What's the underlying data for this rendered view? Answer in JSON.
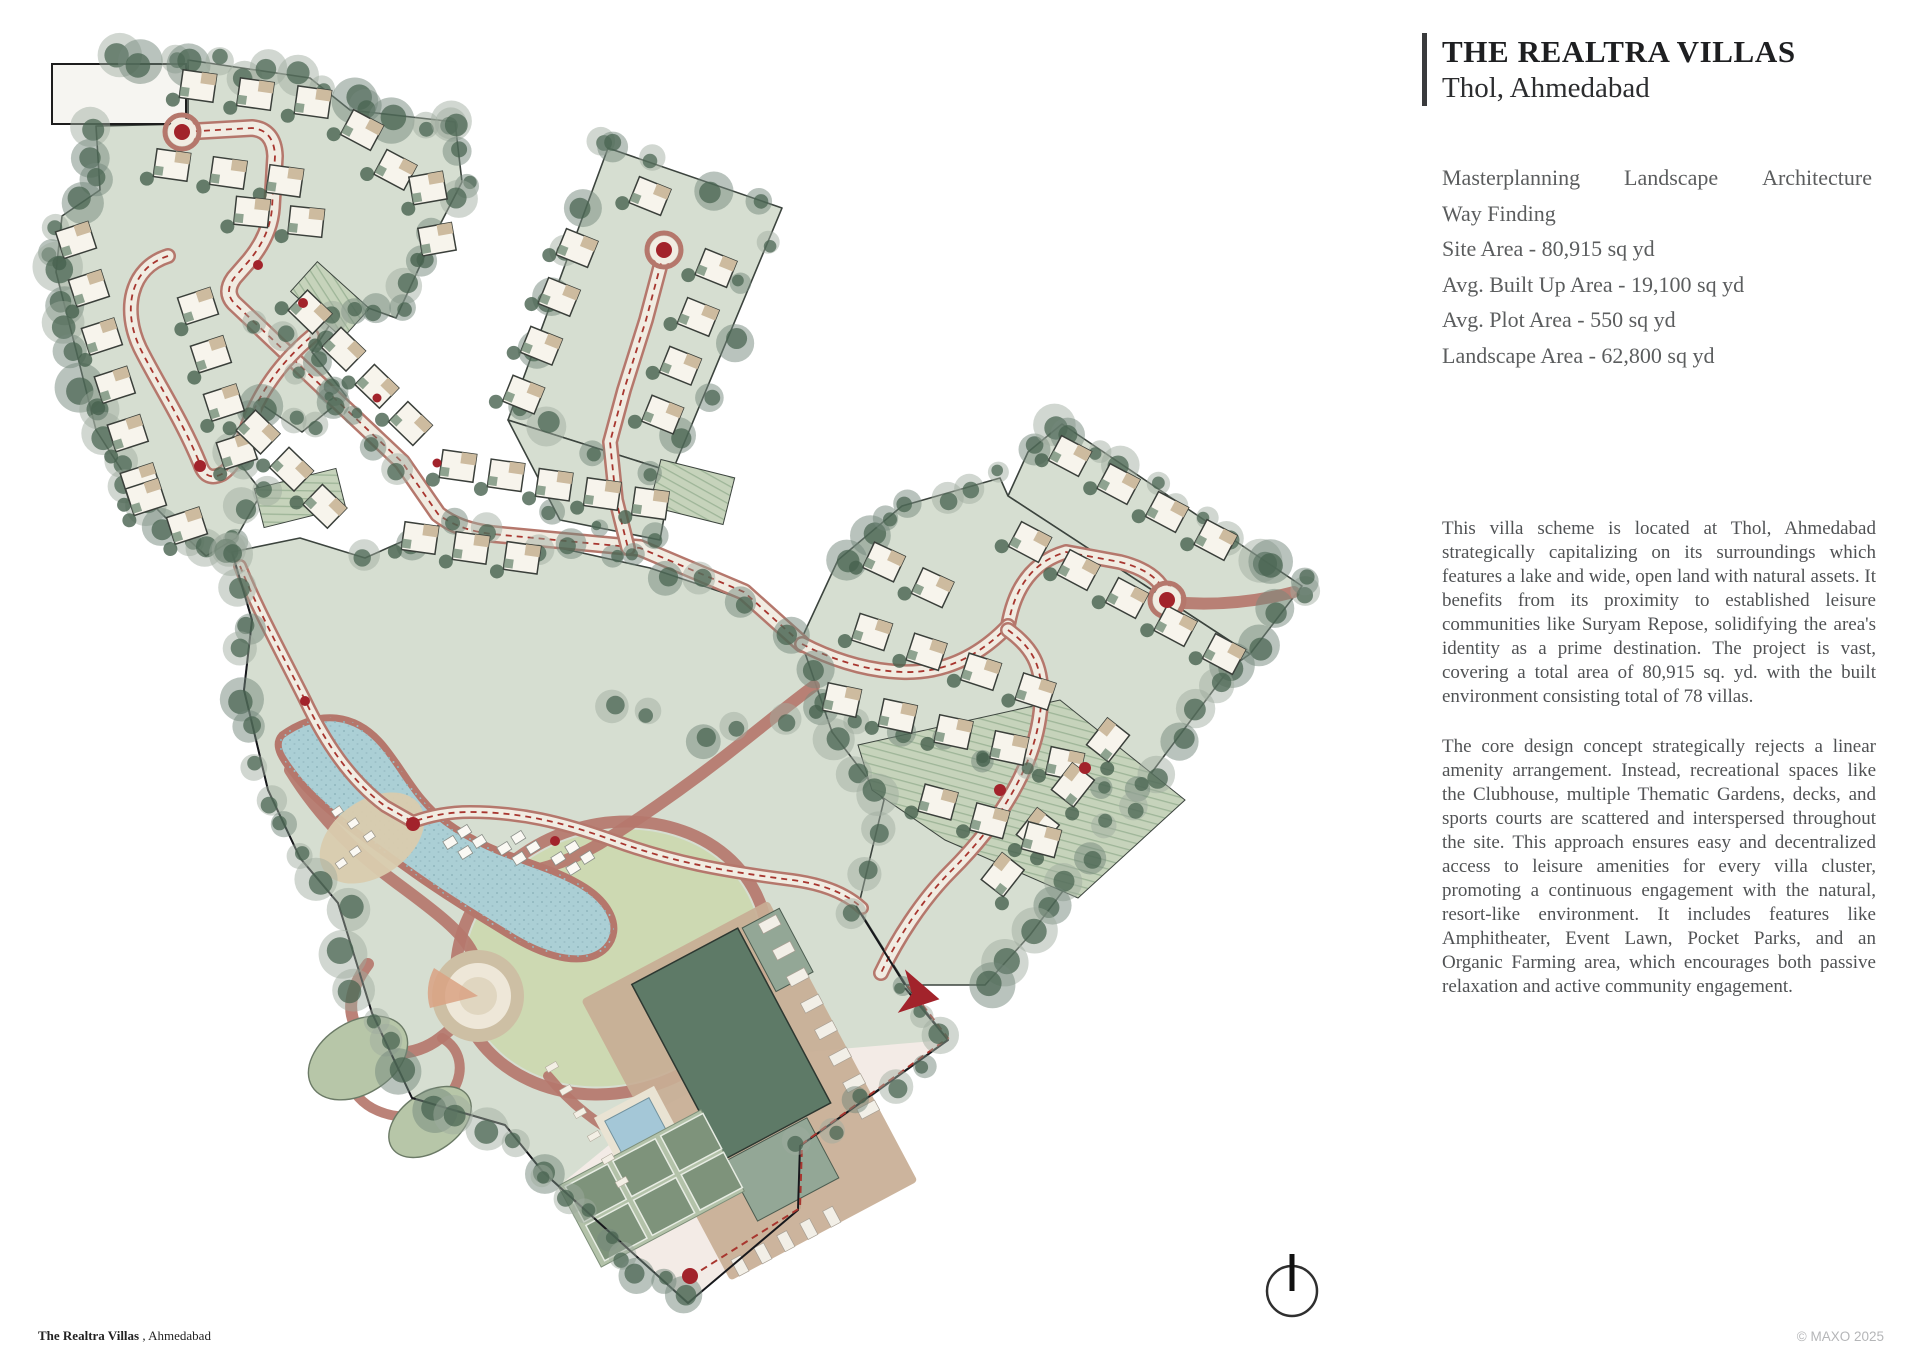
{
  "header": {
    "title": "THE REALTRA VILLAS",
    "subtitle": "Thol, Ahmedabad"
  },
  "details": {
    "words": [
      "Masterplanning",
      "Landscape",
      "Architecture"
    ],
    "line2": "Way Finding",
    "specs": [
      "Site Area - 80,915 sq yd",
      "Avg. Built Up Area - 19,100 sq yd",
      "Avg. Plot Area - 550 sq yd",
      "Landscape Area - 62,800 sq yd"
    ]
  },
  "paragraphs": {
    "p1": "This villa scheme is located at Thol, Ahmedabad strategically capitalizing on its surroundings which features a lake and wide, open land with natural assets. It benefits from its proximity to established leisure communities like Suryam Repose, solidifying the area's identity as a prime destination. The project is vast, covering a total area of 80,915 sq. yd. with the built environment consisting total of 78 villas.",
    "p2": "The core design concept strategically rejects a linear amenity arrangement. Instead, recreational spaces like the Clubhouse, multiple Thematic Gardens, decks, and sports courts are scattered and interspersed throughout the site. This approach ensures easy and decentralized access to leisure amenities for every villa cluster, promoting a continuous engagement with the natural, resort-like environment. It includes features like Amphitheater, Event Lawn, Pocket Parks, and an Organic Farming area, which encourages both passive relaxation and active community engagement."
  },
  "footer": {
    "project": "The Realtra Villas",
    "location": " , Ahmedabad",
    "copyright": "© MAXO 2025"
  },
  "palette": {
    "ink": "#1e1f21",
    "title_gray": "#2c2d2f",
    "body_gray": "#505254",
    "detail_gray": "#5b5d5e",
    "copyright_gray": "#b5b6b8",
    "plot": "#d6ded1",
    "plot_line": "#3c443e",
    "lawn": "#cdd9b2",
    "lake": "#abcfd5",
    "road_fill": "#f1ece2",
    "road_edge": "#b5776c",
    "dash_red": "#a8362f",
    "marker_red": "#a2232b",
    "tree_dark": "#47624f",
    "tree_mid": "#73887b",
    "tree_light": "#9fac9f",
    "tan": "#c8ae95",
    "beach": "#d9cbae",
    "club_dark": "#5e7a67",
    "club_mid": "#93a796",
    "court": "#7e937b",
    "pool": "#a4c7d7",
    "hatch_base": "#c6d3bb",
    "hatch_line": "#9eb598",
    "plaza": "#f3ebe6",
    "boundary": "#17181c"
  }
}
